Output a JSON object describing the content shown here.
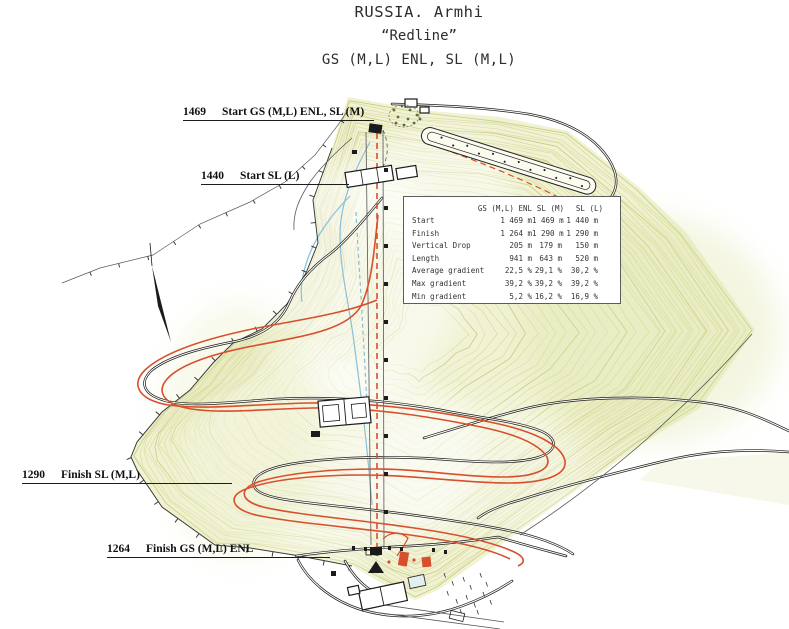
{
  "title": {
    "line1": "RUSSIA. Armhi",
    "line2": "“Redline”",
    "line3": "GS (M,L) ENL, SL (M,L)"
  },
  "elevation_labels": [
    {
      "elevation": "1469",
      "label": "Start GS (M,L) ENL, SL (M)"
    },
    {
      "elevation": "1440",
      "label": "Start SL (L)"
    },
    {
      "elevation": "1290",
      "label": "Finish SL (M,L)"
    },
    {
      "elevation": "1264",
      "label": "Finish GS (M,L) ENL"
    }
  ],
  "table": {
    "columns": [
      "GS (M,L) ENL",
      "SL (M)",
      "SL (L)"
    ],
    "rows": [
      {
        "label": "Start",
        "values": [
          "1 469 m",
          "1 469 m",
          "1 440 m"
        ]
      },
      {
        "label": "Finish",
        "values": [
          "1 264 m",
          "1 290 m",
          "1 290 m"
        ]
      },
      {
        "label": "Vertical Drop",
        "values": [
          "205 m",
          "179 m",
          "150 m"
        ]
      },
      {
        "label": "Length",
        "values": [
          "941 m",
          "643 m",
          "520 m"
        ]
      },
      {
        "label": "Average gradient",
        "values": [
          "22,5 %",
          "29,1 %",
          "30,2 %"
        ]
      },
      {
        "label": "Max gradient",
        "values": [
          "39,2 %",
          "39,2 %",
          "39,2 %"
        ]
      },
      {
        "label": "Min gradient",
        "values": [
          "5,2 %",
          "16,2 %",
          "16,9 %"
        ]
      }
    ]
  },
  "icons": {
    "north_arrow": "north-arrow-icon"
  },
  "colors": {
    "terrain": "#f0f2d2",
    "contour": "#d5d996",
    "contour_index": "#c4ca7b",
    "road": "#1c1c1c",
    "course_red": "#d84f2e",
    "stream_blue": "#88bfd9",
    "text": "#2d2d2d"
  }
}
